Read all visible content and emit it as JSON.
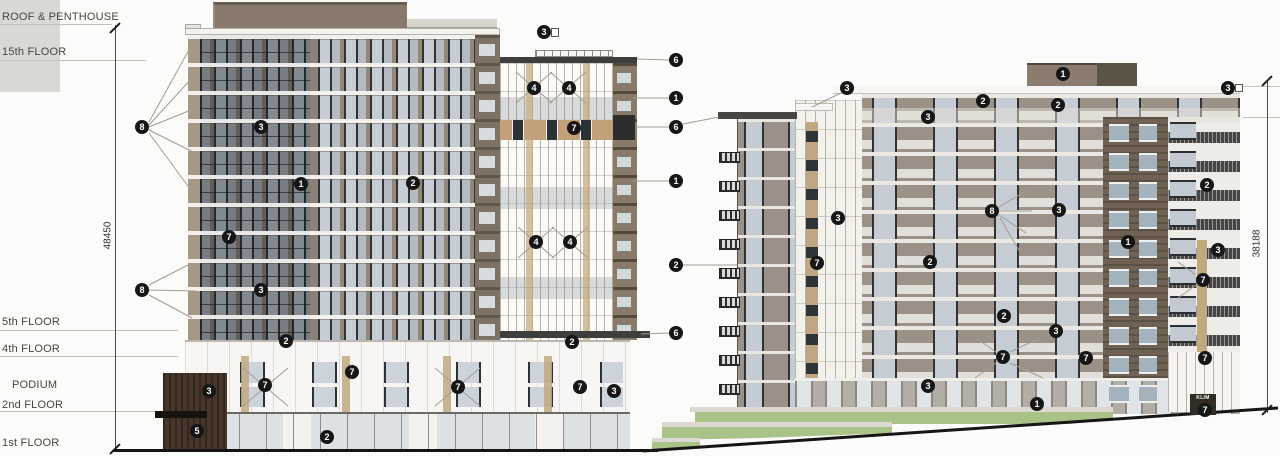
{
  "drawing": {
    "left_margin": {
      "floor_labels": [
        {
          "label": "ROOF & PENTHOUSE",
          "x": 2,
          "y": 11,
          "line_x": 0,
          "line_y": 24,
          "line_w": 112
        },
        {
          "label": "15th FLOOR",
          "x": 2,
          "y": 46,
          "line_x": 0,
          "line_y": 60,
          "line_w": 146
        },
        {
          "label": "5th FLOOR",
          "x": 2,
          "y": 316,
          "line_x": 0,
          "line_y": 330,
          "line_w": 178
        },
        {
          "label": "4th FLOOR",
          "x": 2,
          "y": 343,
          "line_x": 0,
          "line_y": 356,
          "line_w": 178
        },
        {
          "label": "PODIUM",
          "x": 12,
          "y": 379
        },
        {
          "label": "2nd FLOOR",
          "x": 2,
          "y": 399,
          "line_x": 0,
          "line_y": 411,
          "line_w": 186
        },
        {
          "label": "1st FLOOR",
          "x": 2,
          "y": 437
        }
      ]
    },
    "dimensions": {
      "left": {
        "value": "48450"
      },
      "right": {
        "value": "38188"
      }
    },
    "sign": {
      "text": "KLIM"
    },
    "callouts": [
      {
        "n": "8",
        "x": 142,
        "y": 127
      },
      {
        "n": "8",
        "x": 142,
        "y": 290
      },
      {
        "n": "3",
        "x": 261,
        "y": 127
      },
      {
        "n": "1",
        "x": 301,
        "y": 184
      },
      {
        "n": "2",
        "x": 413,
        "y": 183
      },
      {
        "n": "7",
        "x": 229,
        "y": 237
      },
      {
        "n": "3",
        "x": 261,
        "y": 290
      },
      {
        "n": "2",
        "x": 286,
        "y": 341
      },
      {
        "n": "3",
        "x": 544,
        "y": 32
      },
      {
        "n": "4",
        "x": 534,
        "y": 88
      },
      {
        "n": "4",
        "x": 569,
        "y": 88
      },
      {
        "n": "7",
        "x": 574,
        "y": 128
      },
      {
        "n": "4",
        "x": 536,
        "y": 242
      },
      {
        "n": "4",
        "x": 570,
        "y": 242
      },
      {
        "n": "2",
        "x": 572,
        "y": 342
      },
      {
        "n": "3",
        "x": 209,
        "y": 391
      },
      {
        "n": "7",
        "x": 265,
        "y": 385
      },
      {
        "n": "7",
        "x": 352,
        "y": 372
      },
      {
        "n": "5",
        "x": 197,
        "y": 431
      },
      {
        "n": "2",
        "x": 327,
        "y": 437
      },
      {
        "n": "7",
        "x": 458,
        "y": 387
      },
      {
        "n": "7",
        "x": 580,
        "y": 387
      },
      {
        "n": "3",
        "x": 614,
        "y": 391
      },
      {
        "n": "6",
        "x": 676,
        "y": 60
      },
      {
        "n": "1",
        "x": 676,
        "y": 98
      },
      {
        "n": "6",
        "x": 676,
        "y": 127
      },
      {
        "n": "1",
        "x": 676,
        "y": 181
      },
      {
        "n": "2",
        "x": 676,
        "y": 265
      },
      {
        "n": "6",
        "x": 676,
        "y": 333
      },
      {
        "n": "1",
        "x": 1063,
        "y": 74
      },
      {
        "n": "3",
        "x": 847,
        "y": 88
      },
      {
        "n": "3",
        "x": 1228,
        "y": 88
      },
      {
        "n": "2",
        "x": 983,
        "y": 101
      },
      {
        "n": "2",
        "x": 1058,
        "y": 105
      },
      {
        "n": "3",
        "x": 928,
        "y": 117
      },
      {
        "n": "2",
        "x": 1207,
        "y": 185
      },
      {
        "n": "8",
        "x": 992,
        "y": 211
      },
      {
        "n": "3",
        "x": 1059,
        "y": 210
      },
      {
        "n": "3",
        "x": 838,
        "y": 218
      },
      {
        "n": "1",
        "x": 1128,
        "y": 242
      },
      {
        "n": "3",
        "x": 1218,
        "y": 250
      },
      {
        "n": "2",
        "x": 930,
        "y": 262
      },
      {
        "n": "7",
        "x": 817,
        "y": 263
      },
      {
        "n": "7",
        "x": 1203,
        "y": 280
      },
      {
        "n": "2",
        "x": 1004,
        "y": 316
      },
      {
        "n": "3",
        "x": 1056,
        "y": 331
      },
      {
        "n": "7",
        "x": 1003,
        "y": 357
      },
      {
        "n": "7",
        "x": 1086,
        "y": 358
      },
      {
        "n": "7",
        "x": 1205,
        "y": 358
      },
      {
        "n": "3",
        "x": 928,
        "y": 386
      },
      {
        "n": "1",
        "x": 1037,
        "y": 404
      },
      {
        "n": "7",
        "x": 1205,
        "y": 410
      }
    ],
    "leader_lines": [
      [
        149,
        122,
        190,
        48
      ],
      [
        149,
        125,
        192,
        78
      ],
      [
        149,
        127,
        196,
        108
      ],
      [
        149,
        130,
        193,
        152
      ],
      [
        149,
        133,
        196,
        197
      ],
      [
        149,
        285,
        190,
        264
      ],
      [
        149,
        290,
        196,
        291
      ],
      [
        149,
        295,
        192,
        318
      ],
      [
        669,
        60,
        637,
        59
      ],
      [
        669,
        98,
        633,
        98
      ],
      [
        669,
        127,
        636,
        127
      ],
      [
        683,
        124,
        719,
        117
      ],
      [
        669,
        181,
        633,
        181
      ],
      [
        683,
        265,
        737,
        265
      ],
      [
        669,
        333,
        641,
        334
      ],
      [
        999,
        207,
        1028,
        190
      ],
      [
        999,
        211,
        1032,
        211
      ],
      [
        999,
        215,
        1026,
        233
      ],
      [
        1000,
        218,
        1020,
        252
      ],
      [
        841,
        93,
        812,
        107
      ],
      [
        1010,
        352,
        1040,
        338
      ],
      [
        1010,
        363,
        1043,
        378
      ],
      [
        996,
        352,
        976,
        338
      ],
      [
        996,
        363,
        975,
        378
      ],
      [
        1196,
        275,
        1178,
        262
      ],
      [
        1196,
        285,
        1178,
        298
      ],
      [
        516,
        72,
        552,
        103
      ],
      [
        552,
        72,
        516,
        103
      ],
      [
        550,
        72,
        586,
        103
      ],
      [
        586,
        72,
        550,
        103
      ],
      [
        518,
        227,
        554,
        258
      ],
      [
        554,
        227,
        518,
        258
      ],
      [
        552,
        227,
        588,
        258
      ],
      [
        588,
        227,
        552,
        258
      ],
      [
        435,
        368,
        480,
        406
      ],
      [
        480,
        368,
        435,
        406
      ],
      [
        243,
        368,
        288,
        406
      ],
      [
        288,
        368,
        243,
        406
      ]
    ],
    "palette": {
      "background": "#fbfbf9",
      "callout_bg": "#161616",
      "callout_text": "#ffffff",
      "floor_line": "#c3c0b9",
      "dim_line": "#4a4a47",
      "label_text": "#474642",
      "podium_box": "#d8d8d5",
      "taupe_pier": "#8d8276",
      "brick": "#7d7265",
      "penthouse": "#87796c",
      "glass": "#c7cdd4",
      "frame_dark": "#2f3336",
      "white_panel": "#f7f6f3",
      "tan_band": "#c2a079",
      "cornice": "#3e3e3c",
      "facade_gray": "#9b9186",
      "grass": "#a9c287",
      "ground_line": "#161616"
    }
  }
}
